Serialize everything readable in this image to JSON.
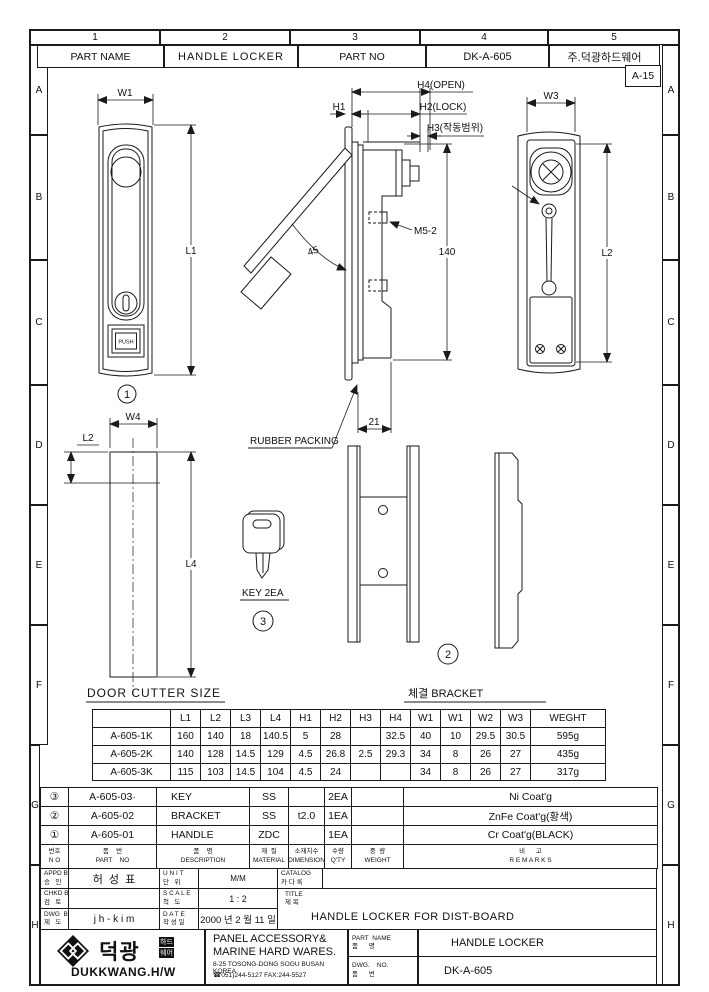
{
  "rulers": {
    "cols": [
      "1",
      "2",
      "3",
      "4",
      "5"
    ],
    "rows": [
      "A",
      "B",
      "C",
      "D",
      "E",
      "F",
      "G",
      "H"
    ]
  },
  "header": {
    "part_name_label": "PART NAME",
    "part_name_value": "HANDLE LOCKER",
    "part_no_label": "PART NO",
    "part_no_value": "DK-A-605",
    "company": "주.덕광하드웨어",
    "sheet_no": "A-15"
  },
  "drawing": {
    "front": {
      "w1": "W1",
      "l1": "L1",
      "push": "PUSH",
      "balloon": "1"
    },
    "side": {
      "h1": "H1",
      "h2": "H2(LOCK)",
      "h3": "H3(작동범위)",
      "h4": "H4(OPEN)",
      "m5": "M5-2",
      "h140": "140",
      "angle": "45",
      "d21": "21",
      "rubber": "RUBBER PACKING"
    },
    "back": {
      "w3": "W3",
      "l2": "L2"
    },
    "cutter": {
      "w4": "W4",
      "l2": "L2",
      "l4": "L4",
      "caption": "DOOR CUTTER SIZE"
    },
    "key": {
      "caption": "KEY 2EA",
      "balloon": "3"
    },
    "bracket": {
      "caption": "체결 BRACKET",
      "balloon": "2"
    }
  },
  "dim_table": {
    "headers": [
      "",
      "L1",
      "L2",
      "L3",
      "L4",
      "H1",
      "H2",
      "H3",
      "H4",
      "W1",
      "W1",
      "W2",
      "W3",
      "WEGHT"
    ],
    "rows": [
      [
        "A-605-1K",
        "160",
        "140",
        "18",
        "140.5",
        "5",
        "28",
        "",
        "32.5",
        "40",
        "10",
        "29.5",
        "30.5",
        "595g"
      ],
      [
        "A-605-2K",
        "140",
        "128",
        "14.5",
        "129",
        "4.5",
        "26.8",
        "2.5",
        "29.3",
        "34",
        "8",
        "26",
        "27",
        "435g"
      ],
      [
        "A-605-3K",
        "115",
        "103",
        "14.5",
        "104",
        "4.5",
        "24",
        "",
        "",
        "34",
        "8",
        "26",
        "27",
        "317g"
      ]
    ]
  },
  "bom": {
    "cols": [
      {
        "kr": "번호",
        "en": "N O"
      },
      {
        "kr": "품    번",
        "en": "PART    NO"
      },
      {
        "kr": "품    명",
        "en": "DESCRIPTION"
      },
      {
        "kr": "재  질",
        "en": "MATERIAL"
      },
      {
        "kr": "소재치수",
        "en": "DIMENSION"
      },
      {
        "kr": "수량",
        "en": "Q'TY"
      },
      {
        "kr": "중  량",
        "en": "WEIGHT"
      },
      {
        "kr": "비      고",
        "en": "R E M A R K S"
      }
    ],
    "rows": [
      {
        "no": "③",
        "part": "A-605-03·",
        "desc": "KEY",
        "mat": "SS",
        "dim": "",
        "qty": "2EA",
        "wt": "",
        "rem": "Ni Coat'g"
      },
      {
        "no": "②",
        "part": "A-605-02",
        "desc": "BRACKET",
        "mat": "SS",
        "dim": "t2.0",
        "qty": "1EA",
        "wt": "",
        "rem": "ZnFe Coat'g(황색)"
      },
      {
        "no": "①",
        "part": "A-605-01",
        "desc": "HANDLE",
        "mat": "ZDC",
        "dim": "",
        "qty": "1EA",
        "wt": "",
        "rem": "Cr Coat'g(BLACK)"
      }
    ]
  },
  "title_block": {
    "appd": {
      "en": "APPD BY",
      "kr": "승   인",
      "val": "허  성  표"
    },
    "chkd": {
      "en": "CHKD BY",
      "kr": "검   토",
      "val": ""
    },
    "dwg": {
      "en": "DWG  BY",
      "kr": "제   도",
      "val": "j h - k i m"
    },
    "unit": {
      "en": "U N I T",
      "kr": "단   위",
      "val": "M/M"
    },
    "scale": {
      "en": "S C A L E",
      "kr": "척   도",
      "val": "1 : 2"
    },
    "date": {
      "en": "D A T E",
      "kr": "작 성 일",
      "val": "2000 년 2 월 11 일"
    },
    "catalog": {
      "en": "CATALOG",
      "kr": "카 다 록"
    },
    "title": {
      "en": "TITLE",
      "kr": "제 목",
      "val": "HANDLE LOCKER FOR DIST-BOARD"
    }
  },
  "company": {
    "logo_kr": "덕광",
    "logo_b1": "하드",
    "logo_b2": "웨어",
    "logo_en": "DUKKWANG.H/W",
    "addr1": "PANEL ACCESSORY&",
    "addr2": "MARINE HARD WARES.",
    "addr3": "8-25 TOSONG-DONG SOGU BUSAN KOREA",
    "addr4": "☎051)244-5127 FAX:244-5527",
    "pn": {
      "en": "PART  NAME",
      "kr": "품      명",
      "val": "HANDLE LOCKER"
    },
    "dn": {
      "en": "DWG.    NO.",
      "kr": "품      번",
      "val": "DK-A-605"
    }
  }
}
